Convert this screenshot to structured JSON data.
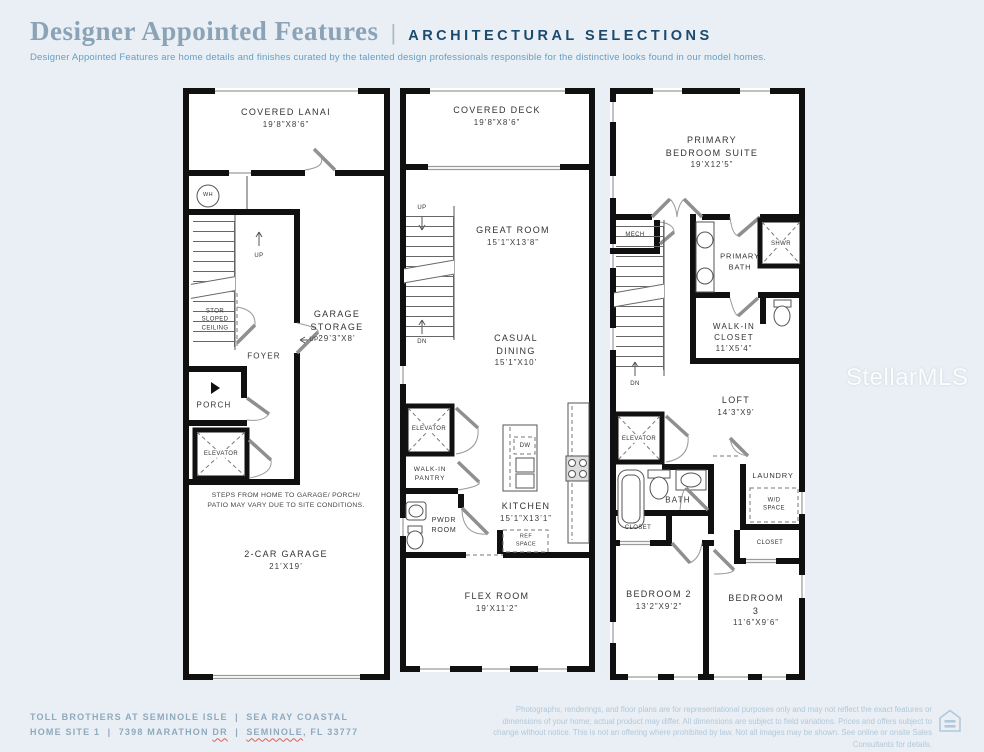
{
  "header": {
    "title": "Designer Appointed Features",
    "separator": "|",
    "tagline": "ARCHITECTURAL SELECTIONS",
    "description": "Designer Appointed Features are home details and finishes curated by the talented design professionals responsible for the distinctive looks found in our model homes."
  },
  "watermark": "StellarMLS",
  "colors": {
    "background": "#e9eff4",
    "title_blue": "#8ba3b6",
    "accent_navy": "#1b4a6e",
    "description_blue": "#669ec4",
    "footer_blue": "#8fa9bd",
    "disclaimer_blue": "#b2c8da",
    "wall_black": "#101010",
    "spellcheck_red": "#d9604f"
  },
  "floor1": {
    "covered_lanai": {
      "name": "COVERED LANAI",
      "dims": "19’8”X8’6”"
    },
    "wh": "WH",
    "up1": "UP",
    "stor": "STOR\nSLOPED\nCEILING",
    "foyer": "FOYER",
    "garage_storage": {
      "name": "GARAGE\nSTORAGE",
      "dims": "29’3”X8’"
    },
    "up2": "UP",
    "porch": "PORCH",
    "elevator": "ELEVATOR",
    "note": "STEPS FROM HOME TO GARAGE/ PORCH/\nPATIO MAY VARY DUE TO SITE CONDITIONS.",
    "garage": {
      "name": "2-CAR GARAGE",
      "dims": "21’X19’"
    }
  },
  "floor2": {
    "covered_deck": {
      "name": "COVERED DECK",
      "dims": "19’8”X8’6”"
    },
    "up": "UP",
    "great_room": {
      "name": "GREAT ROOM",
      "dims": "15’1”X13’8”"
    },
    "casual_dining": {
      "name": "CASUAL DINING",
      "dims": "15’1”X10’"
    },
    "dn": "DN",
    "elevator": "ELEVATOR",
    "walkin_pantry": "WALK-IN\nPANTRY",
    "pwdr": "PWDR\nROOM",
    "dw": "DW",
    "kitchen": {
      "name": "KITCHEN",
      "dims": "15’1”X13’1”"
    },
    "ref_space": "REF\nSPACE",
    "flex_room": {
      "name": "FLEX ROOM",
      "dims": "19’X11’2”"
    }
  },
  "floor3": {
    "primary_suite": {
      "name": "PRIMARY\nBEDROOM SUITE",
      "dims": "19’X12’5”"
    },
    "mech": "MECH",
    "primary_bath": "PRIMARY\nBATH",
    "shwr": "SHWR",
    "walkin_closet": {
      "name": "WALK-IN\nCLOSET",
      "dims": "11’X5’4”"
    },
    "dn": "DN",
    "loft": {
      "name": "LOFT",
      "dims": "14’3”X9’"
    },
    "elevator": "ELEVATOR",
    "bath": "BATH",
    "laundry": "LAUNDRY",
    "wd_space": "W/D\nSPACE",
    "closet_left": "CLOSET",
    "closet_right": "CLOSET",
    "bedroom2": {
      "name": "BEDROOM 2",
      "dims": "13’2”X9’2”"
    },
    "bedroom3": {
      "name": "BEDROOM 3",
      "dims": "11’6”X9’6”"
    }
  },
  "footer": {
    "line1": "TOLL BROTHERS AT SEMINOLE ISLE  |  SEA RAY COASTAL",
    "line2_parts": [
      {
        "text": "HOME SITE 1  |  7398 MARATHON "
      },
      {
        "text": "DR"
      },
      {
        "text": "  |  "
      },
      {
        "text": "SEMINOLE"
      },
      {
        "text": ", FL 33777"
      }
    ],
    "disclaimer": "Photographs, renderings, and floor plans are for representational purposes only and may not reflect the exact features or dimensions of your home; actual product may differ. All dimensions are subject to field variations. Prices and offers subject to change without notice. This is not an offering where prohibited by law. Not all images may be shown. See online or onsite Sales Consultants for details."
  }
}
